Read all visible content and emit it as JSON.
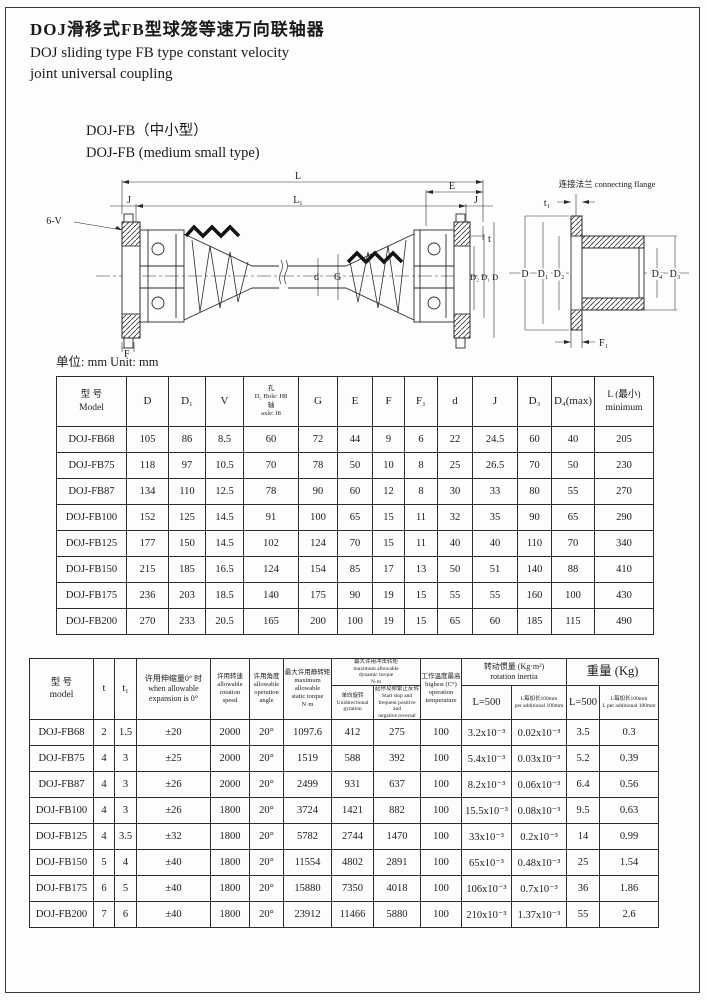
{
  "page": {
    "title_zh": "DOJ滑移式FB型球笼等速万向联轴器",
    "title_en_line1": "DOJ sliding type FB type constant velocity",
    "title_en_line2": "joint universal coupling",
    "subtitle_zh": "DOJ-FB（中小型）",
    "subtitle_en": "DOJ-FB (medium small type)",
    "unit_note": "单位: mm Unit: mm"
  },
  "drawing": {
    "main_labels": {
      "L": "L",
      "L1": "L₁",
      "E": "E",
      "J_left": "J",
      "J_right": "J",
      "six_v": "6-V",
      "t": "t",
      "d": "d",
      "G": "G",
      "F": "F",
      "D2": "D₂",
      "D1": "D₁",
      "D": "D"
    },
    "flange_labels": {
      "title": "连接法兰 connecting flange",
      "t1": "t₁",
      "D": "D",
      "D1": "D₁",
      "D2": "D₂",
      "D4": "D₄",
      "D3": "D₃",
      "F1": "F₁"
    }
  },
  "table1": {
    "headers": {
      "model_zh": "型 号",
      "model_en": "Model",
      "D": "D",
      "D1": "D₁",
      "V": "V",
      "D2_l1": "孔",
      "D2_l2": "D₂ Hole: H8",
      "D2_l3": "轴",
      "D2_l4": "axle: f8",
      "G": "G",
      "E": "E",
      "F": "F",
      "F1": "F₁",
      "d": "d",
      "J": "J",
      "D3": "D₃",
      "D4": "D₄(max)",
      "L_l1": "L (最小)",
      "L_l2": "minimum"
    },
    "rows": [
      [
        "DOJ-FB68",
        "105",
        "86",
        "8.5",
        "60",
        "72",
        "44",
        "9",
        "6",
        "22",
        "24.5",
        "60",
        "40",
        "205"
      ],
      [
        "DOJ-FB75",
        "118",
        "97",
        "10.5",
        "70",
        "78",
        "50",
        "10",
        "8",
        "25",
        "26.5",
        "70",
        "50",
        "230"
      ],
      [
        "DOJ-FB87",
        "134",
        "110",
        "12.5",
        "78",
        "90",
        "60",
        "12",
        "8",
        "30",
        "33",
        "80",
        "55",
        "270"
      ],
      [
        "DOJ-FB100",
        "152",
        "125",
        "14.5",
        "91",
        "100",
        "65",
        "15",
        "11",
        "32",
        "35",
        "90",
        "65",
        "290"
      ],
      [
        "DOJ-FB125",
        "177",
        "150",
        "14.5",
        "102",
        "124",
        "70",
        "15",
        "11",
        "40",
        "40",
        "110",
        "70",
        "340"
      ],
      [
        "DOJ-FB150",
        "215",
        "185",
        "16.5",
        "124",
        "154",
        "85",
        "17",
        "13",
        "50",
        "51",
        "140",
        "88",
        "410"
      ],
      [
        "DOJ-FB175",
        "236",
        "203",
        "18.5",
        "140",
        "175",
        "90",
        "19",
        "15",
        "55",
        "55",
        "160",
        "100",
        "430"
      ],
      [
        "DOJ-FB200",
        "270",
        "233",
        "20.5",
        "165",
        "200",
        "100",
        "19",
        "15",
        "65",
        "60",
        "185",
        "115",
        "490"
      ]
    ]
  },
  "table2": {
    "headers": {
      "model_zh": "型 号",
      "model_en": "model",
      "t": "t",
      "t1": "t₁",
      "exp_zh": "许用伸缩量0° 时",
      "exp_en1": "when allowable",
      "exp_en2": "expansion is 0°",
      "speed_zh": "许用转速",
      "speed_en1": "allowable",
      "speed_en2": "rotation",
      "speed_en3": "speed",
      "angle_zh": "许用角度",
      "angle_en1": "allowable",
      "angle_en2": "operation",
      "angle_en3": "angle",
      "static_zh": "最大许用静转矩",
      "static_en1": "maximum allowable",
      "static_en2": "static torque",
      "static_unit": "N·m",
      "dyn_zh": "最大许用冲击转矩",
      "dyn_en1": "maximum allowable",
      "dyn_en2": "dynamic torque",
      "dyn_unit": "N·m",
      "dyn_uni_zh": "单向旋转",
      "dyn_uni_en1": "Unidirectional",
      "dyn_uni_en2": "gyration",
      "dyn_rev_zh": "起停及频繁正反转",
      "dyn_rev_en1": "Start stop and",
      "dyn_rev_en2": "frequent positive and",
      "dyn_rev_en3": "negative reversal",
      "temp_zh": "工作温度最高",
      "temp_en1": "highest  (C°)",
      "temp_en2": "operation",
      "temp_en3": "temperature",
      "inertia_zh": "转动惯量 (Kg·m²)",
      "inertia_en": "rotation inertia",
      "inertia_l500": "L=500",
      "inertia_per_zh": "L每加长100mm",
      "inertia_per_en": "per additional 100mm",
      "weight": "重量 (Kg)",
      "weight_l500": "L=500",
      "weight_per_zh": "L每加长100mm",
      "weight_per_en": "L per additional 100mm"
    },
    "rows": [
      [
        "DOJ-FB68",
        "2",
        "1.5",
        "±20",
        "2000",
        "20°",
        "1097.6",
        "412",
        "275",
        "100",
        "3.2x10⁻³",
        "0.02x10⁻³",
        "3.5",
        "0.3"
      ],
      [
        "DOJ-FB75",
        "4",
        "3",
        "±25",
        "2000",
        "20°",
        "1519",
        "588",
        "392",
        "100",
        "5.4x10⁻³",
        "0.03x10⁻³",
        "5.2",
        "0.39"
      ],
      [
        "DOJ-FB87",
        "4",
        "3",
        "±26",
        "2000",
        "20°",
        "2499",
        "931",
        "637",
        "100",
        "8.2x10⁻³",
        "0.06x10⁻³",
        "6.4",
        "0.56"
      ],
      [
        "DOJ-FB100",
        "4",
        "3",
        "±26",
        "1800",
        "20°",
        "3724",
        "1421",
        "882",
        "100",
        "15.5x10⁻³",
        "0.08x10⁻³",
        "9.5",
        "0.63"
      ],
      [
        "DOJ-FB125",
        "4",
        "3.5",
        "±32",
        "1800",
        "20°",
        "5782",
        "2744",
        "1470",
        "100",
        "33x10⁻³",
        "0.2x10⁻³",
        "14",
        "0.99"
      ],
      [
        "DOJ-FB150",
        "5",
        "4",
        "±40",
        "1800",
        "20°",
        "11554",
        "4802",
        "2891",
        "100",
        "65x10⁻³",
        "0.48x10⁻³",
        "25",
        "1.54"
      ],
      [
        "DOJ-FB175",
        "6",
        "5",
        "±40",
        "1800",
        "20°",
        "15880",
        "7350",
        "4018",
        "100",
        "106x10⁻³",
        "0.7x10⁻³",
        "36",
        "1.86"
      ],
      [
        "DOJ-FB200",
        "7",
        "6",
        "±40",
        "1800",
        "20°",
        "23912",
        "11466",
        "5880",
        "100",
        "210x10⁻³",
        "1.37x10⁻³",
        "55",
        "2.6"
      ]
    ]
  }
}
